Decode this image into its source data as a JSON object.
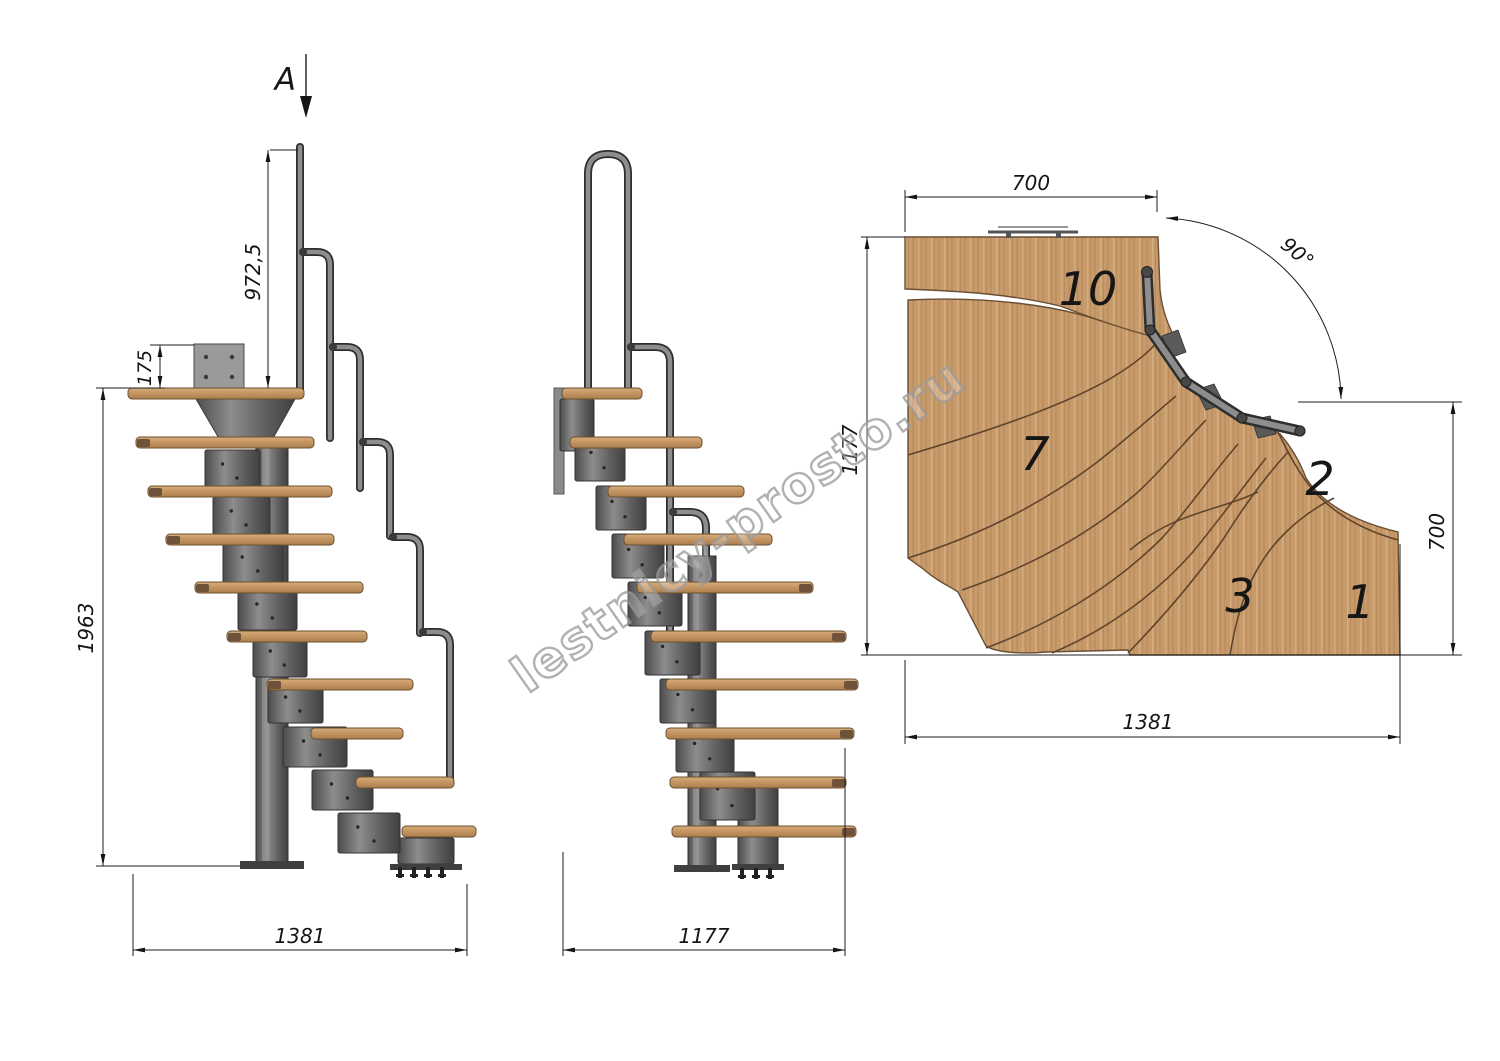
{
  "watermark": "lestnicy-prosto.ru",
  "section_view": {
    "marker": "A"
  },
  "side_view": {
    "handrail_height": "972,5",
    "top_plate_offset": "175",
    "total_height": "1963",
    "total_run": "1381"
  },
  "front_view": {
    "total_depth": "1177"
  },
  "plan_view": {
    "top_width": "700",
    "turn_angle": "90°",
    "left_depth": "1177",
    "right_depth": "700",
    "bottom_width": "1381",
    "treads": {
      "t10": "10",
      "t7": "7",
      "t2": "2",
      "t3": "3",
      "t1": "1"
    }
  },
  "colors": {
    "wood": "#c79a6b",
    "wood_dark": "#6e523a",
    "metal": "#6f6f6f",
    "metal_dark": "#3c3c3c",
    "line": "#1c1c1c",
    "watermark_gray": "#9c9c9c"
  }
}
